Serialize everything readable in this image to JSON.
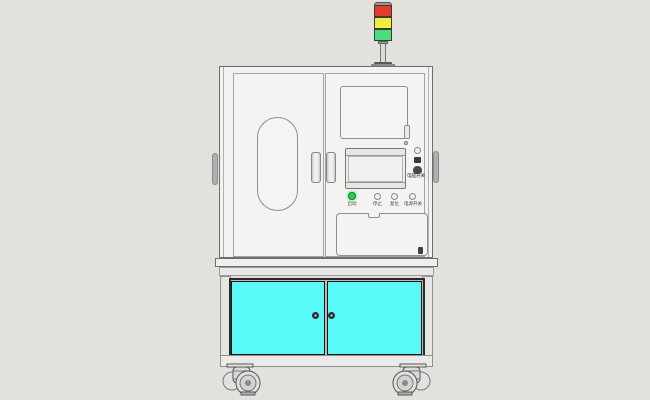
{
  "scene": {
    "background_color": "#e3e1de",
    "machine_body_color": "#f3f2f0",
    "outline_color": "#6f6f6d"
  },
  "tower_light": {
    "segments": [
      {
        "name": "red",
        "color": "#e33b2c"
      },
      {
        "name": "yellow",
        "color": "#f2ee3c"
      },
      {
        "name": "green",
        "color": "#47e07a"
      }
    ]
  },
  "control_panel": {
    "power_cluster_label": "电脑开关",
    "buttons": [
      {
        "label": "启动",
        "lit": true,
        "color": "#2ad14b"
      },
      {
        "label": "停止",
        "lit": false,
        "color": "#f0efed"
      },
      {
        "label": "复位",
        "lit": false,
        "color": "#f0efed"
      },
      {
        "label": "电源开关",
        "lit": false,
        "color": "#f0efed"
      }
    ]
  },
  "lower_cabinet": {
    "door_color": "#58f9f9",
    "door_count": 2
  }
}
